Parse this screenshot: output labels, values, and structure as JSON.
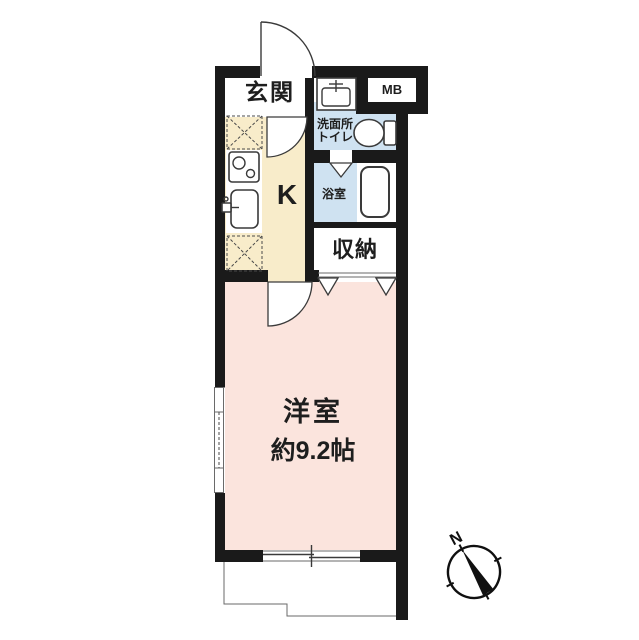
{
  "plan": {
    "labels": {
      "entrance": "玄関",
      "meter_box": "MB",
      "washroom_line1": "洗面所",
      "washroom_line2": "トイレ",
      "kitchen": "K",
      "bathroom": "浴室",
      "storage": "収納",
      "room": "洋室",
      "room_area": "約9.2帖",
      "compass_north": "N"
    },
    "colors": {
      "wall": "#1a1a1a",
      "kitchen_floor": "#f8ecca",
      "wet_floor": "#cfe2f1",
      "room_floor": "#fbe4dd",
      "floor_white": "#ffffff",
      "line": "#3a3a3a"
    }
  }
}
